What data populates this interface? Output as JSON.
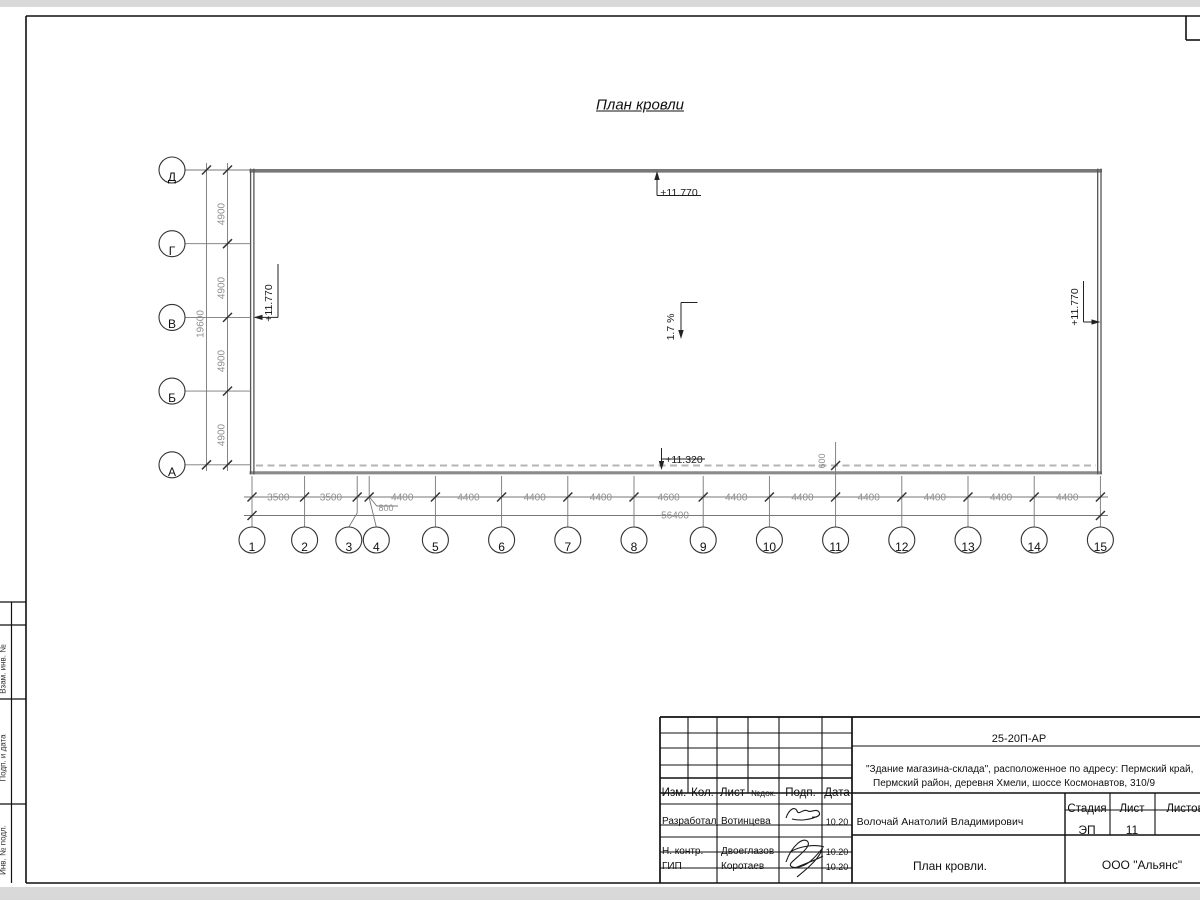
{
  "page_title": "План кровли",
  "roof": {
    "slope": "1.7 %",
    "elev_top": "+11.770",
    "elev_left": "+11.770",
    "elev_right": "+11.770",
    "elev_low": "+11.320",
    "parapet_offset": "600"
  },
  "axes": {
    "rows": [
      "Д",
      "Г",
      "В",
      "Б",
      "А"
    ],
    "cols": [
      "1",
      "2",
      "3",
      "4",
      "5",
      "6",
      "7",
      "8",
      "9",
      "10",
      "11",
      "12",
      "13",
      "14",
      "15"
    ]
  },
  "dims": {
    "bottom": [
      "3500",
      "3500",
      "800",
      "4400",
      "4400",
      "4400",
      "4400",
      "4600",
      "4400",
      "4400",
      "4400",
      "4400",
      "4400",
      "4400"
    ],
    "bottom_total": "56400",
    "left": [
      "4900",
      "4900",
      "4900",
      "4900"
    ],
    "left_total": "19600"
  },
  "titleblock": {
    "doc_number": "25-20П-АР",
    "project_line1": "\"Здание магазина-склада\", расположенное по адресу: Пермский край,",
    "project_line2": "Пермский район, деревня Хмели, шоссе Космонавтов, 310/9",
    "header": [
      "Изм.",
      "Кол.",
      "Лист",
      "№док.",
      "Подп.",
      "Дата"
    ],
    "rows": [
      {
        "role": "Разработал",
        "name": "Вотинцева",
        "date": "10.20"
      },
      {
        "role": "Н. контр.",
        "name": "Двоеглазов",
        "date": "10.20"
      },
      {
        "role": "ГИП",
        "name": "Коротаев",
        "date": "10.20"
      }
    ],
    "author": "Волочай Анатолий Владимирович",
    "stage_label": "Стадия",
    "sheet_label": "Лист",
    "sheets_label": "Листов",
    "stage": "ЭП",
    "sheet": "11",
    "doc_title": "План кровли.",
    "company": "ООО \"Альянс\""
  },
  "side_stamp": {
    "labels": [
      "Взам. инв. №",
      "Подп. и дата",
      "Инв. № подл."
    ]
  }
}
